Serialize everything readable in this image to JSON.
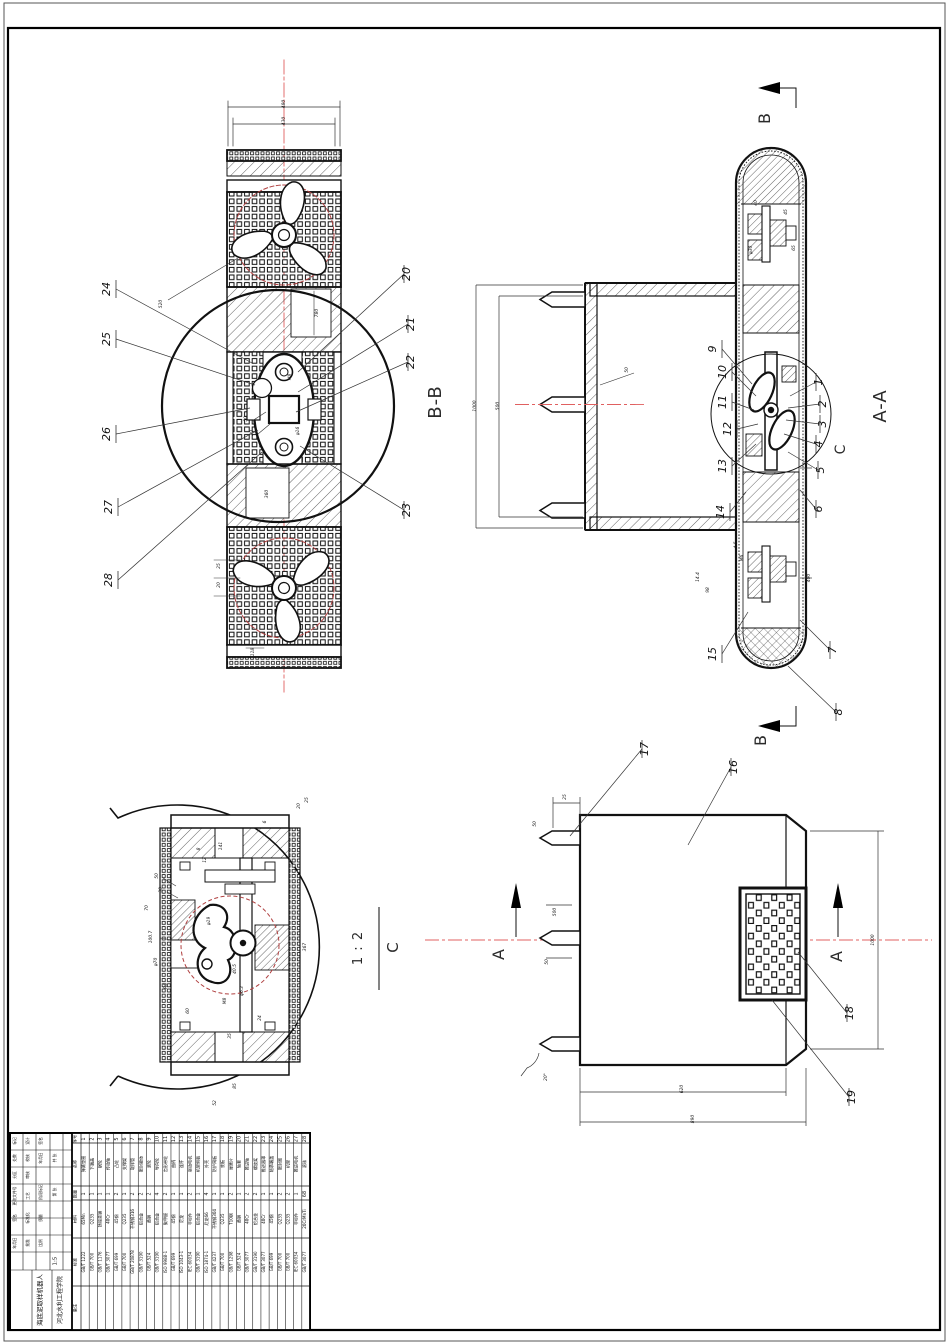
{
  "sheet": {
    "scale": "1:5",
    "title": "海底泥取样机器人",
    "organization": "河北水利工程学院",
    "tb_small_labels": [
      "标记",
      "处数",
      "分区",
      "更改文件号",
      "签名",
      "年月日",
      "设计",
      "校核",
      "审核",
      "工艺",
      "标准化",
      "批准",
      "签名",
      "年月日",
      "阶段标记",
      "质量",
      "比例",
      "共 张",
      "第 张"
    ]
  },
  "section_labels": {
    "bb": "B-B",
    "aa": "A-A",
    "detail_letter_ref": "C",
    "detail_letter": "C",
    "detail_scale": "1 : 2",
    "arrow_b_top": "B",
    "arrow_b_bottom": "B",
    "arrow_a_left": "A",
    "arrow_a_right": "A"
  },
  "callouts": {
    "bb_left": [
      "24",
      "25",
      "26",
      "27",
      "28"
    ],
    "bb_right": [
      "20",
      "21",
      "22",
      "23"
    ],
    "aa_left": [
      "9",
      "10",
      "11",
      "12",
      "13",
      "14",
      "15"
    ],
    "aa_right": [
      "1",
      "2",
      "3",
      "4",
      "5",
      "6",
      "7",
      "8"
    ],
    "main": [
      "16",
      "17",
      "18",
      "19"
    ]
  },
  "dimensions": {
    "bb": [
      "480",
      "430",
      "520",
      "780",
      "360",
      "50",
      "30",
      "M8",
      "φ16",
      "25",
      "20",
      "118"
    ],
    "aa": [
      "1000",
      "500",
      "400",
      "50",
      "40",
      "45",
      "65",
      "φ30",
      "M6",
      "4.5",
      "14.4",
      "98"
    ],
    "main": [
      "620",
      "890",
      "1000",
      "500",
      "50",
      "25",
      "50",
      "20°"
    ],
    "detail": [
      "141",
      "25",
      "6",
      "8",
      "12",
      "50",
      "30",
      "70",
      "φ19",
      "100.7",
      "φ70",
      "R5",
      "367",
      "40.5",
      "φ6.3",
      "M8",
      "60",
      "24",
      "35",
      "85",
      "52",
      "20"
    ]
  },
  "parts_list": {
    "headers": [
      "序号",
      "名称",
      "数量",
      "材料",
      "标准"
    ],
    "remark_header": "备注",
    "rows": [
      {
        "no": "1",
        "name": "弹簧垫圈",
        "qty": "1",
        "material": "65Mn",
        "standard": "GB/T 1222"
      },
      {
        "no": "2",
        "name": "下端盖",
        "qty": "1",
        "material": "Q235",
        "standard": "GB/T 700"
      },
      {
        "no": "3",
        "name": "蜗轮",
        "qty": "1",
        "material": "铸锡青铜",
        "standard": "GB/T 1176"
      },
      {
        "no": "4",
        "name": "传动轴",
        "qty": "1",
        "material": "40Cr",
        "standard": "GB/T 3077"
      },
      {
        "no": "5",
        "name": "凸轮",
        "qty": "2",
        "material": "45钢",
        "standard": "GB/T 699"
      },
      {
        "no": "6",
        "name": "支撑架",
        "qty": "1",
        "material": "Q235",
        "standard": "GB/T 700"
      },
      {
        "no": "7",
        "name": "取样管",
        "qty": "2",
        "material": "不锈钢316",
        "standard": "GB/T 20878"
      },
      {
        "no": "8",
        "name": "密封舱体",
        "qty": "2",
        "material": "铝合金",
        "standard": "GB/T 3190"
      },
      {
        "no": "9",
        "name": "滚轮",
        "qty": "2",
        "material": "黄铜",
        "standard": "GB/T 524"
      },
      {
        "no": "10",
        "name": "导向轮",
        "qty": "4",
        "material": "铝合金",
        "standard": "GB/T 3190"
      },
      {
        "no": "11",
        "name": "齿形带轮",
        "qty": "2",
        "material": "聚甲醛",
        "standard": "ISO 9988-1"
      },
      {
        "no": "12",
        "name": "曲柄",
        "qty": "1",
        "material": "45钢",
        "standard": "GB/T 699"
      },
      {
        "no": "13",
        "name": "连杆",
        "qty": "1",
        "material": "尼龙",
        "standard": "ISO 1043-1"
      },
      {
        "no": "14",
        "name": "驱动电机",
        "qty": "2",
        "material": "非标件",
        "standard": "IEC 60034"
      },
      {
        "no": "15",
        "name": "机架侧板",
        "qty": "1",
        "material": "铝合金",
        "standard": "GB/T 3190"
      },
      {
        "no": "16",
        "name": "外壳",
        "qty": "4",
        "material": "尼龙66",
        "standard": "ISO 1874-1"
      },
      {
        "no": "17",
        "name": "防护网板",
        "qty": "1",
        "material": "不锈钢304",
        "standard": "GB/T 4237"
      },
      {
        "no": "18",
        "name": "底板",
        "qty": "1",
        "material": "Q235",
        "standard": "GB/T 700"
      },
      {
        "no": "19",
        "name": "弹簧片",
        "qty": "2",
        "material": "T10钢",
        "standard": "GB/T 1298"
      },
      {
        "no": "20",
        "name": "轴套",
        "qty": "1",
        "material": "黄铜",
        "standard": "GB/T 524"
      },
      {
        "no": "21",
        "name": "推进轴",
        "qty": "2",
        "material": "40Cr",
        "standard": "GB/T 3077"
      },
      {
        "no": "22",
        "name": "螺旋桨",
        "qty": "2",
        "material": "铝合金",
        "standard": "GB/T 3190"
      },
      {
        "no": "23",
        "name": "推进器罩",
        "qty": "1",
        "material": "40Cr",
        "standard": "GB/T 3077"
      },
      {
        "no": "24",
        "name": "轴承端盖",
        "qty": "1",
        "material": "45钢",
        "standard": "GB/T 699"
      },
      {
        "no": "25",
        "name": "密封圈",
        "qty": "2",
        "material": "Q235",
        "standard": "GB/T 700"
      },
      {
        "no": "26",
        "name": "机架",
        "qty": "2",
        "material": "Q235",
        "standard": "GB/T 700"
      },
      {
        "no": "27",
        "name": "推进电机",
        "qty": "1",
        "material": "非标件",
        "standard": "IEC 60034"
      },
      {
        "no": "28",
        "name": "滚珠",
        "qty": "68",
        "material": "20CrMnTi",
        "standard": "GB/T 3077"
      }
    ]
  },
  "colors": {
    "line": "#1a1a1a",
    "centerline_red": "#e06060",
    "dashed_circle_red": "#b04040"
  }
}
